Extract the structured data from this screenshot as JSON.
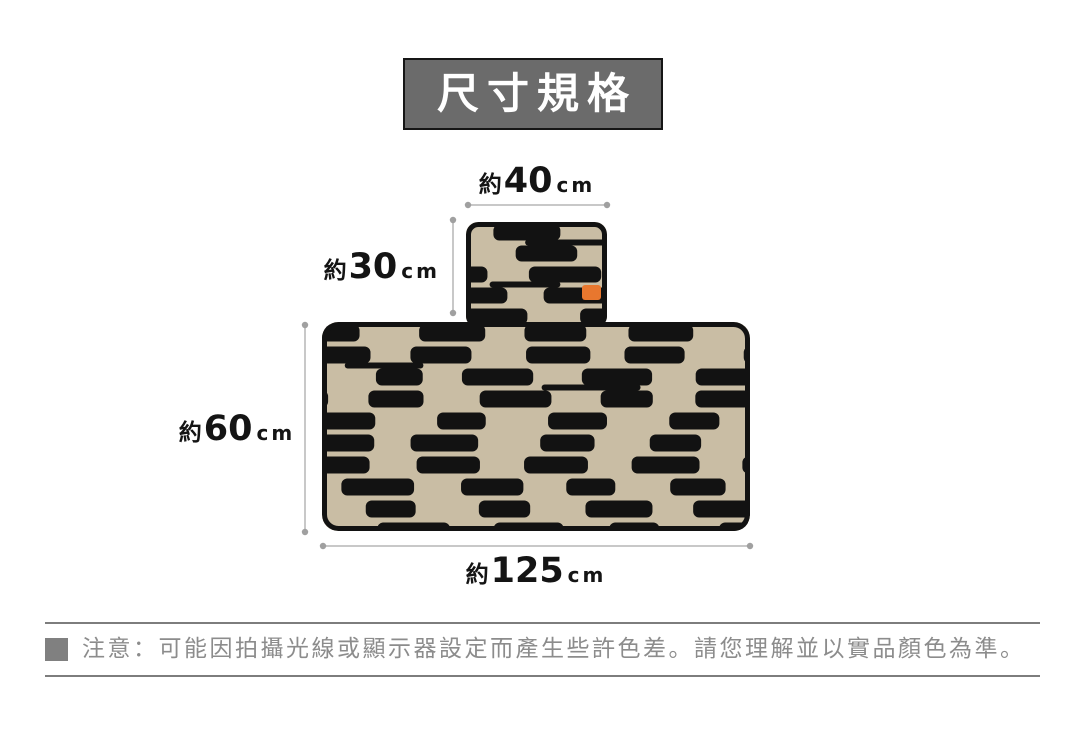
{
  "header": {
    "title": "尺寸規格"
  },
  "diagram": {
    "dimensions": {
      "top_width": {
        "prefix": "約",
        "value": "40",
        "unit": "cm"
      },
      "flap_height": {
        "prefix": "約",
        "value": "30",
        "unit": "cm"
      },
      "body_height": {
        "prefix": "約",
        "value": "60",
        "unit": "cm"
      },
      "body_width": {
        "prefix": "約",
        "value": "125",
        "unit": "cm"
      }
    },
    "colors": {
      "pattern_black": "#121212",
      "pattern_tan": "#c9bda4",
      "tag_orange": "#e8772e",
      "dim_line": "#b5b5b5",
      "dim_dot": "#a0a0a0"
    }
  },
  "note": {
    "text": "注意：可能因拍攝光線或顯示器設定而產生些許色差。請您理解並以實品顏色為準。"
  }
}
